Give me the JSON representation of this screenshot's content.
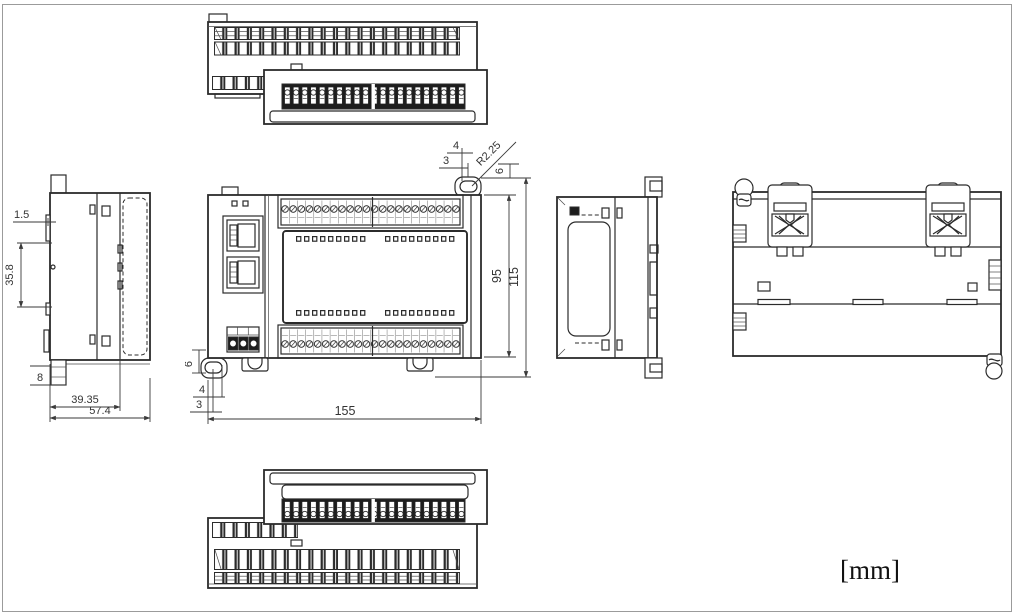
{
  "meta": {
    "unit_label": "[mm]",
    "drawing_subject": "PLC module outline drawing, six orthographic views"
  },
  "colors": {
    "line": "#2b2b2b",
    "dimension": "#3a3a3a",
    "terminal_dark": "#1d1d1d",
    "background": "#ffffff",
    "page_border": "#9b9b9b"
  },
  "dimensions": {
    "left_view": {
      "front_offset": "1.5",
      "connector_height": "35.8",
      "din_tab": "8",
      "depth_to_rail": "39.35",
      "total_depth": "57.4"
    },
    "front_view": {
      "hole_offset_a": "4",
      "hole_offset_b": "3",
      "hole_radius": "R2.25",
      "hole_offset_v": "6",
      "body_height": "95",
      "total_height": "115",
      "foot_offset_v": "6",
      "foot_offset_a": "4",
      "foot_offset_b": "3",
      "total_width": "155"
    }
  }
}
